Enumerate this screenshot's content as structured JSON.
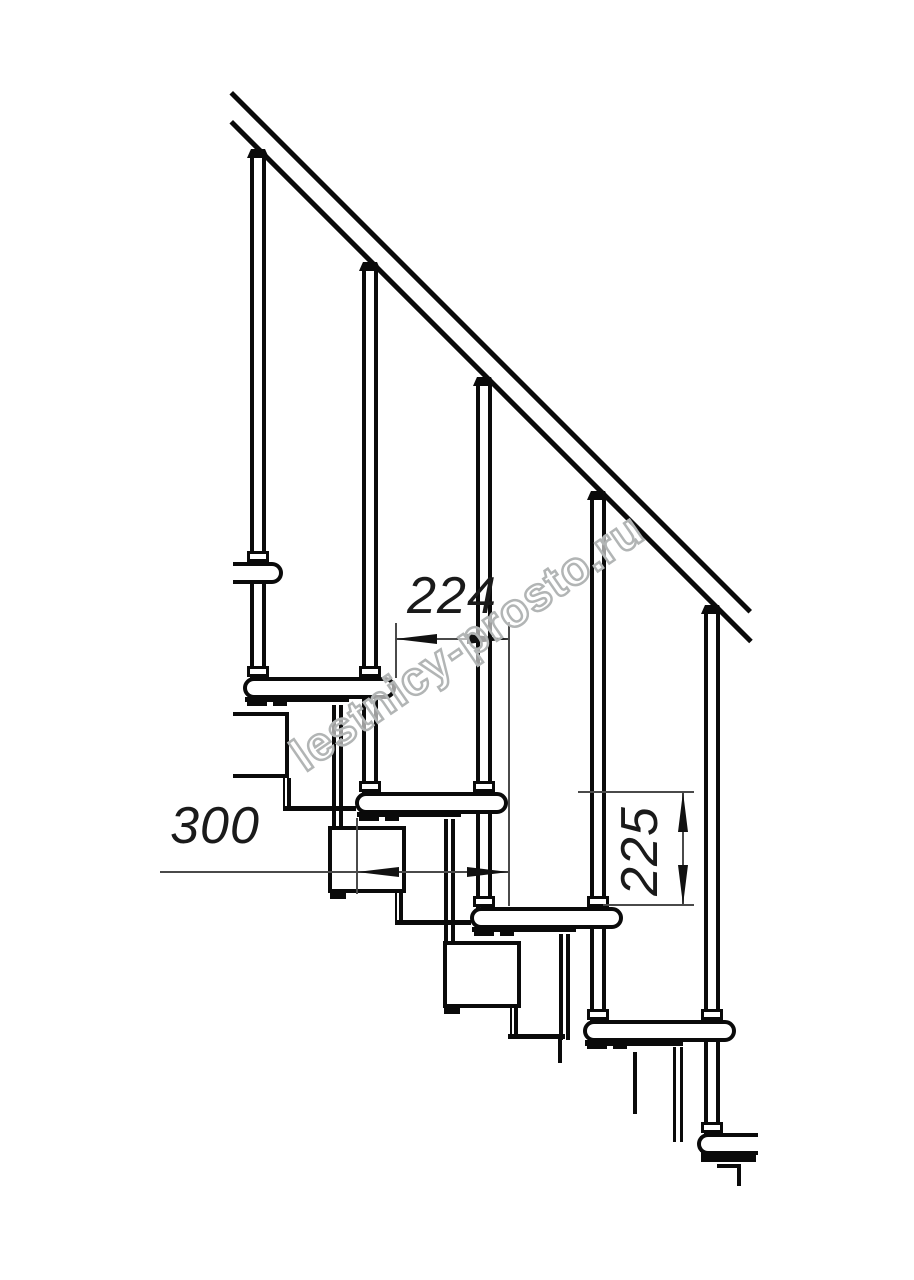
{
  "document": {
    "kind": "technical line drawing",
    "subject": "modular staircase side elevation with handrail"
  },
  "watermark": {
    "text": "lestnicy-prosto.ru"
  },
  "dimensions": {
    "step_run": {
      "value": "224"
    },
    "tread_depth": {
      "value": "300"
    },
    "step_rise": {
      "value": "225"
    }
  },
  "structure": {
    "balusters_visible": 5,
    "treads_visible": 6,
    "handrail_lines": 2
  },
  "colors": {
    "background": "#ffffff",
    "drawing_line": "#0a0a0a",
    "dimension_line": "#4a4a4a",
    "dimension_text": "#1a1a1a",
    "watermark_outline": "#b2b5b5"
  }
}
